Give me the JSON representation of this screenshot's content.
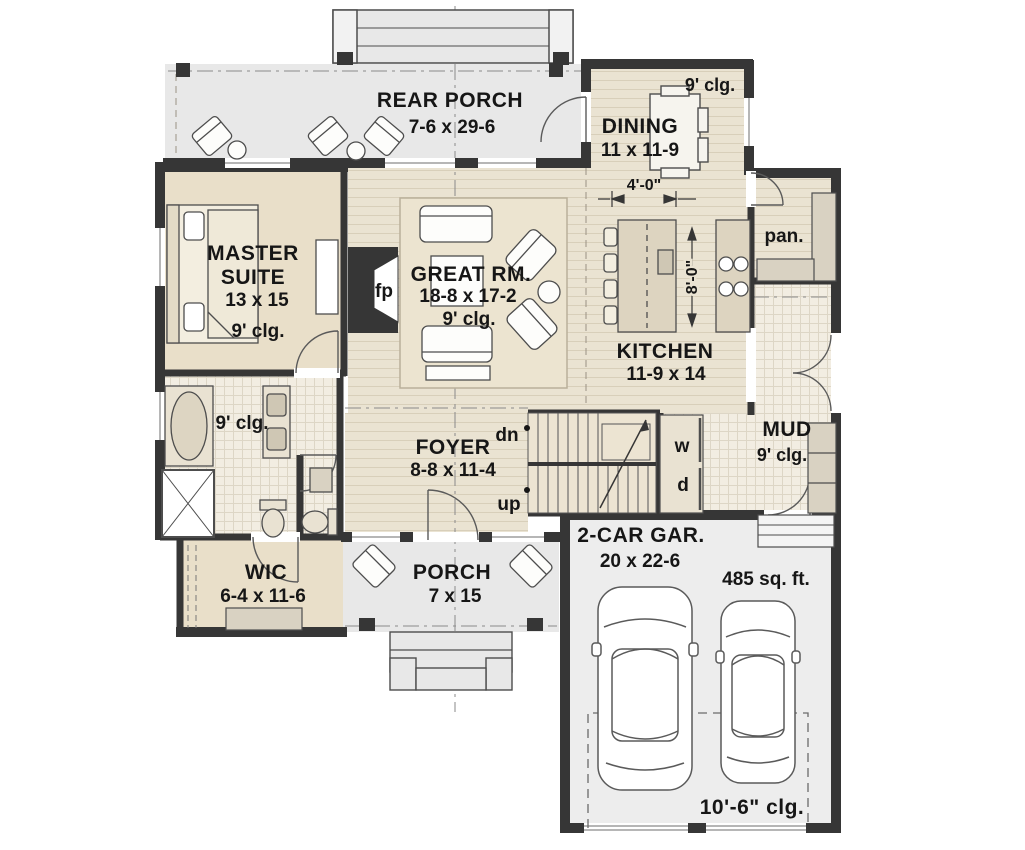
{
  "colors": {
    "wall": "#363636",
    "wood_floor": "#eae3d2",
    "wood_line": "#d8cfba",
    "tile_floor": "#f2ede2",
    "tile_line": "#ddd6c6",
    "solid_floor": "#e9dfc9",
    "porch_floor": "#e8e8e8",
    "garage_floor": "#ededed",
    "cabinet": "#d9d2c2",
    "counter": "#ddd4c0",
    "text": "#161616"
  },
  "plan": {
    "rear_porch": {
      "name": "REAR PORCH",
      "dims": "7-6 x 29-6"
    },
    "dining": {
      "ceiling": "9' clg.",
      "name": "DINING",
      "dims": "11 x 11-9",
      "passage_dim": "4'-0\""
    },
    "pantry": {
      "name": "pan."
    },
    "master_suite": {
      "name_line1": "MASTER",
      "name_line2": "SUITE",
      "dims": "13 x 15",
      "ceiling": "9' clg."
    },
    "fireplace": {
      "label": "fp"
    },
    "great_room": {
      "name": "GREAT RM.",
      "dims": "18-8 x 17-2",
      "ceiling": "9' clg."
    },
    "kitchen": {
      "name": "KITCHEN",
      "dims": "11-9 x 14",
      "island_dim": "8'-0\""
    },
    "mud_room": {
      "name": "MUD",
      "ceiling": "9' clg.",
      "washer": "w",
      "dryer": "d"
    },
    "foyer": {
      "name": "FOYER",
      "dims": "8-8 x 11-4",
      "down": "dn",
      "up": "up"
    },
    "bath": {
      "ceiling": "9' clg."
    },
    "wic": {
      "name": "WIC",
      "dims": "6-4 x 11-6"
    },
    "porch": {
      "name": "PORCH",
      "dims": "7 x 15"
    },
    "garage": {
      "name": "2-CAR GAR.",
      "dims": "20 x 22-6",
      "area": "485 sq. ft.",
      "ceiling": "10'-6\" clg."
    }
  }
}
